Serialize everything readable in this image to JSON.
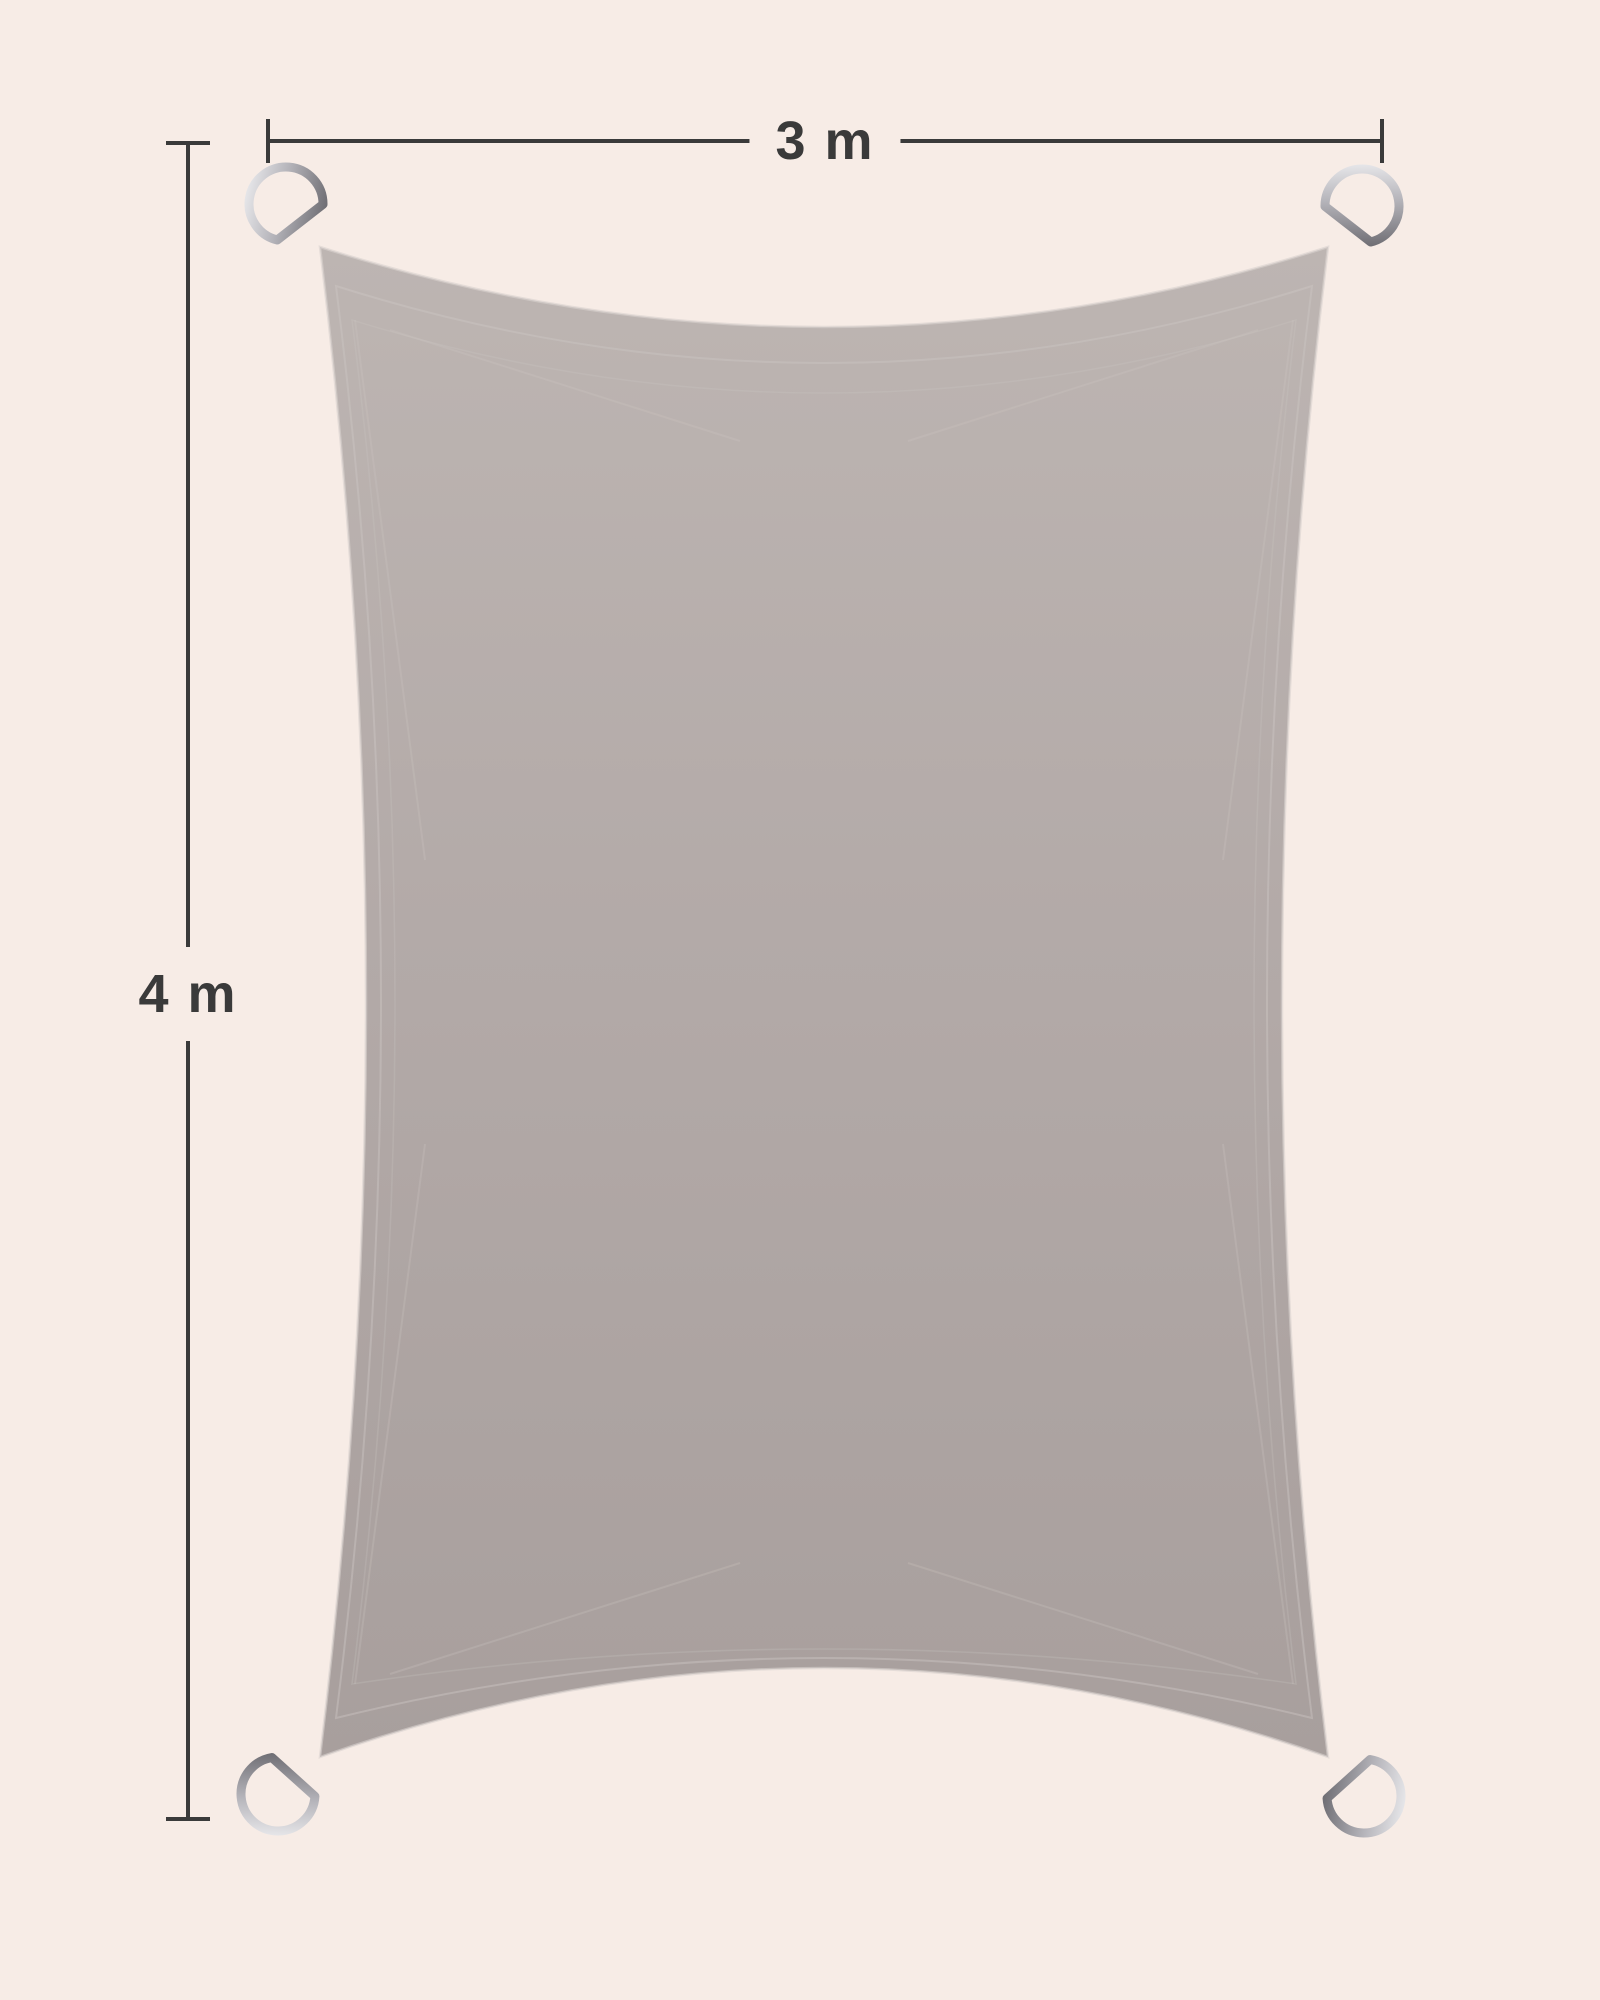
{
  "figure": {
    "type": "product-dimension-diagram",
    "subject": "rectangular shade sail with corner d-rings",
    "width_label": "3 m",
    "height_label": "4 m",
    "corner_hardware": "d-ring",
    "corner_count": 4
  },
  "colors": {
    "background": "#f7ece6",
    "sail_top": "#bdb5b2",
    "sail_base": "#b3aaa8",
    "sail_bottom": "#a89f9d",
    "sail_seam": "#cdc6c3",
    "sail_hem_highlight": "#d8d2cf",
    "annotation": "#3a3a3a",
    "metal_light": "#f4f4f6",
    "metal_mid": "#b5b4ba",
    "metal_dark": "#6e6d73"
  }
}
